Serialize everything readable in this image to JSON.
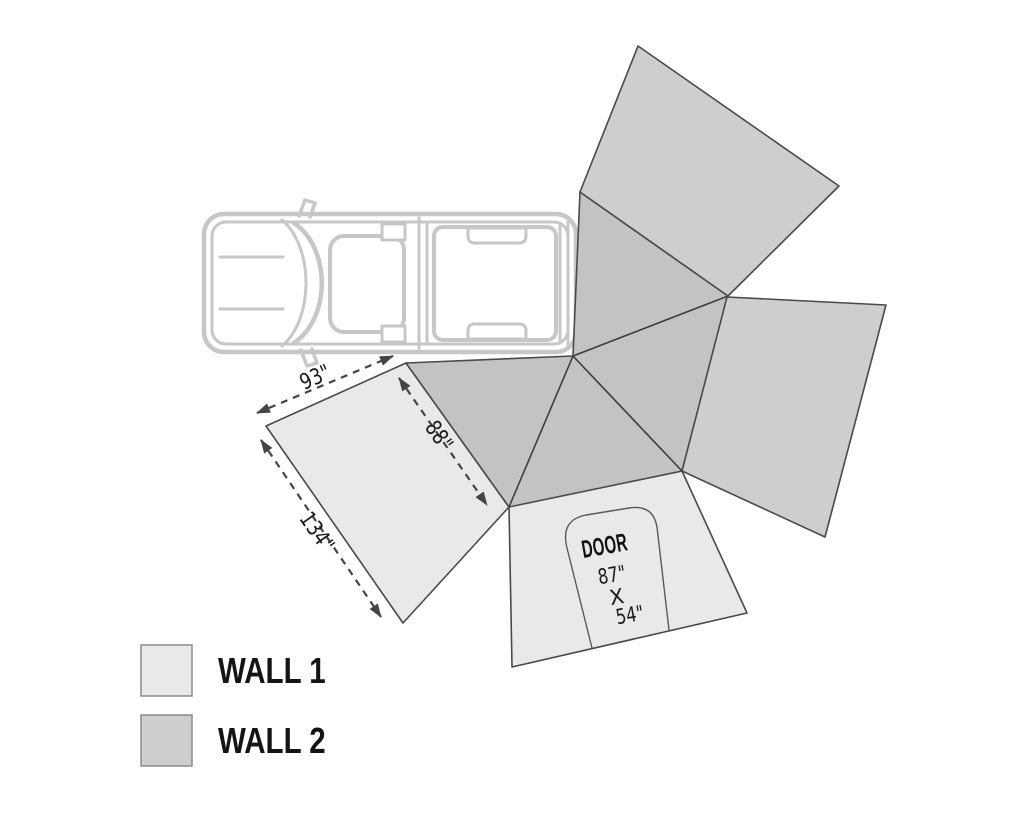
{
  "diagram": {
    "dimensions": {
      "wall1_top_edge": "93\"",
      "canopy_edge": "88\"",
      "wall1_side_edge": "134\""
    },
    "door": {
      "label": "DOOR",
      "height": "87\"",
      "separator": "X",
      "width": "54\""
    }
  },
  "legend": {
    "items": [
      {
        "id": "wall1",
        "label": "WALL 1"
      },
      {
        "id": "wall2",
        "label": "WALL 2"
      }
    ]
  },
  "colors": {
    "wall1_fill": "#e9e9e9",
    "wall2_fill": "#cecece",
    "canopy_fill": "#c3c3c3",
    "panel_outline": "#4a4a4a",
    "dimension_line": "#454545",
    "vehicle_outline": "#c7c7c7",
    "label_text": "#1b1b1b"
  }
}
